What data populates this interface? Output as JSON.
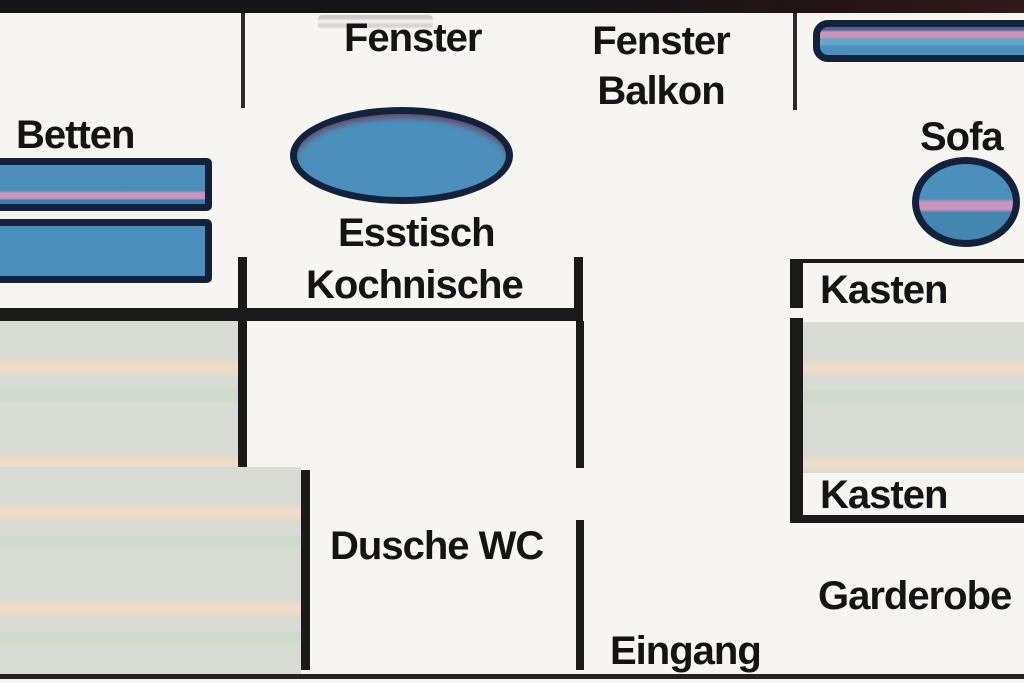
{
  "labels": {
    "window_left": "Fenster",
    "window_balcony_line1": "Fenster",
    "window_balcony_line2": "Balkon",
    "beds": "Betten",
    "dining_table": "Esstisch",
    "kitchenette": "Kochnische",
    "sofa": "Sofa",
    "closet_top": "Kasten",
    "closet_bottom": "Kasten",
    "shower_wc": "Dusche WC",
    "wardrobe": "Garderobe",
    "entrance": "Eingang"
  },
  "colors": {
    "background": "#f6f5f2",
    "wall": "#1a1a1a",
    "furniture_fill": "#4d8fbc",
    "furniture_border": "#13223a",
    "stripe_pink": "#c795bd",
    "shaded_fill": "#d8dcd4",
    "shaded_stripe_warm": "#eedbc9",
    "shaded_stripe_green": "#cfdacc",
    "text": "#141414"
  }
}
